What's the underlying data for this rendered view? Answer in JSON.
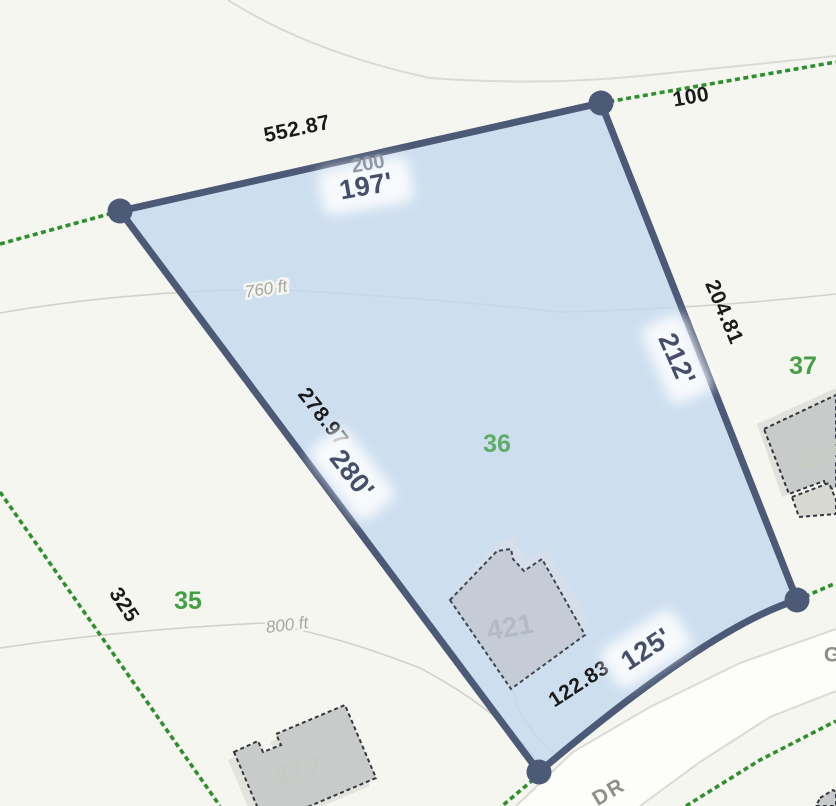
{
  "colors": {
    "background": "#f6f6f1",
    "parcel_fill": "#c3d8ee",
    "parcel_border": "#4d5a77",
    "boundary_green": "#2e8f2e",
    "lot_number_green": "#44a044",
    "gis_label_navy": "#454f6b",
    "deed_label_black": "#1a1a1a",
    "building_fill": "#c9cbcb",
    "road_fill": "#fdfdfa"
  },
  "selected_parcel": {
    "lot_number": "36",
    "house_number": "421",
    "ghost_label": "200",
    "sides": [
      {
        "side": "northwest",
        "deed_length": "552.87",
        "measured_length": "197'"
      },
      {
        "side": "northeast",
        "deed_length": "204.81",
        "measured_length": "212'"
      },
      {
        "side": "southwest",
        "deed_length": "278.97",
        "measured_length": "280'"
      },
      {
        "side": "south",
        "deed_length": "122.83",
        "measured_length": "125'"
      }
    ]
  },
  "adjacent": {
    "north_frontage": "100",
    "west_boundary_length": "325",
    "lot_west": "35",
    "lot_east": "37",
    "house_west": "417",
    "house_east": "425"
  },
  "terrain": {
    "contour_upper": "760 ft",
    "contour_lower": "800 ft"
  },
  "road": {
    "suffix": "DR",
    "partial_letter": "G"
  }
}
